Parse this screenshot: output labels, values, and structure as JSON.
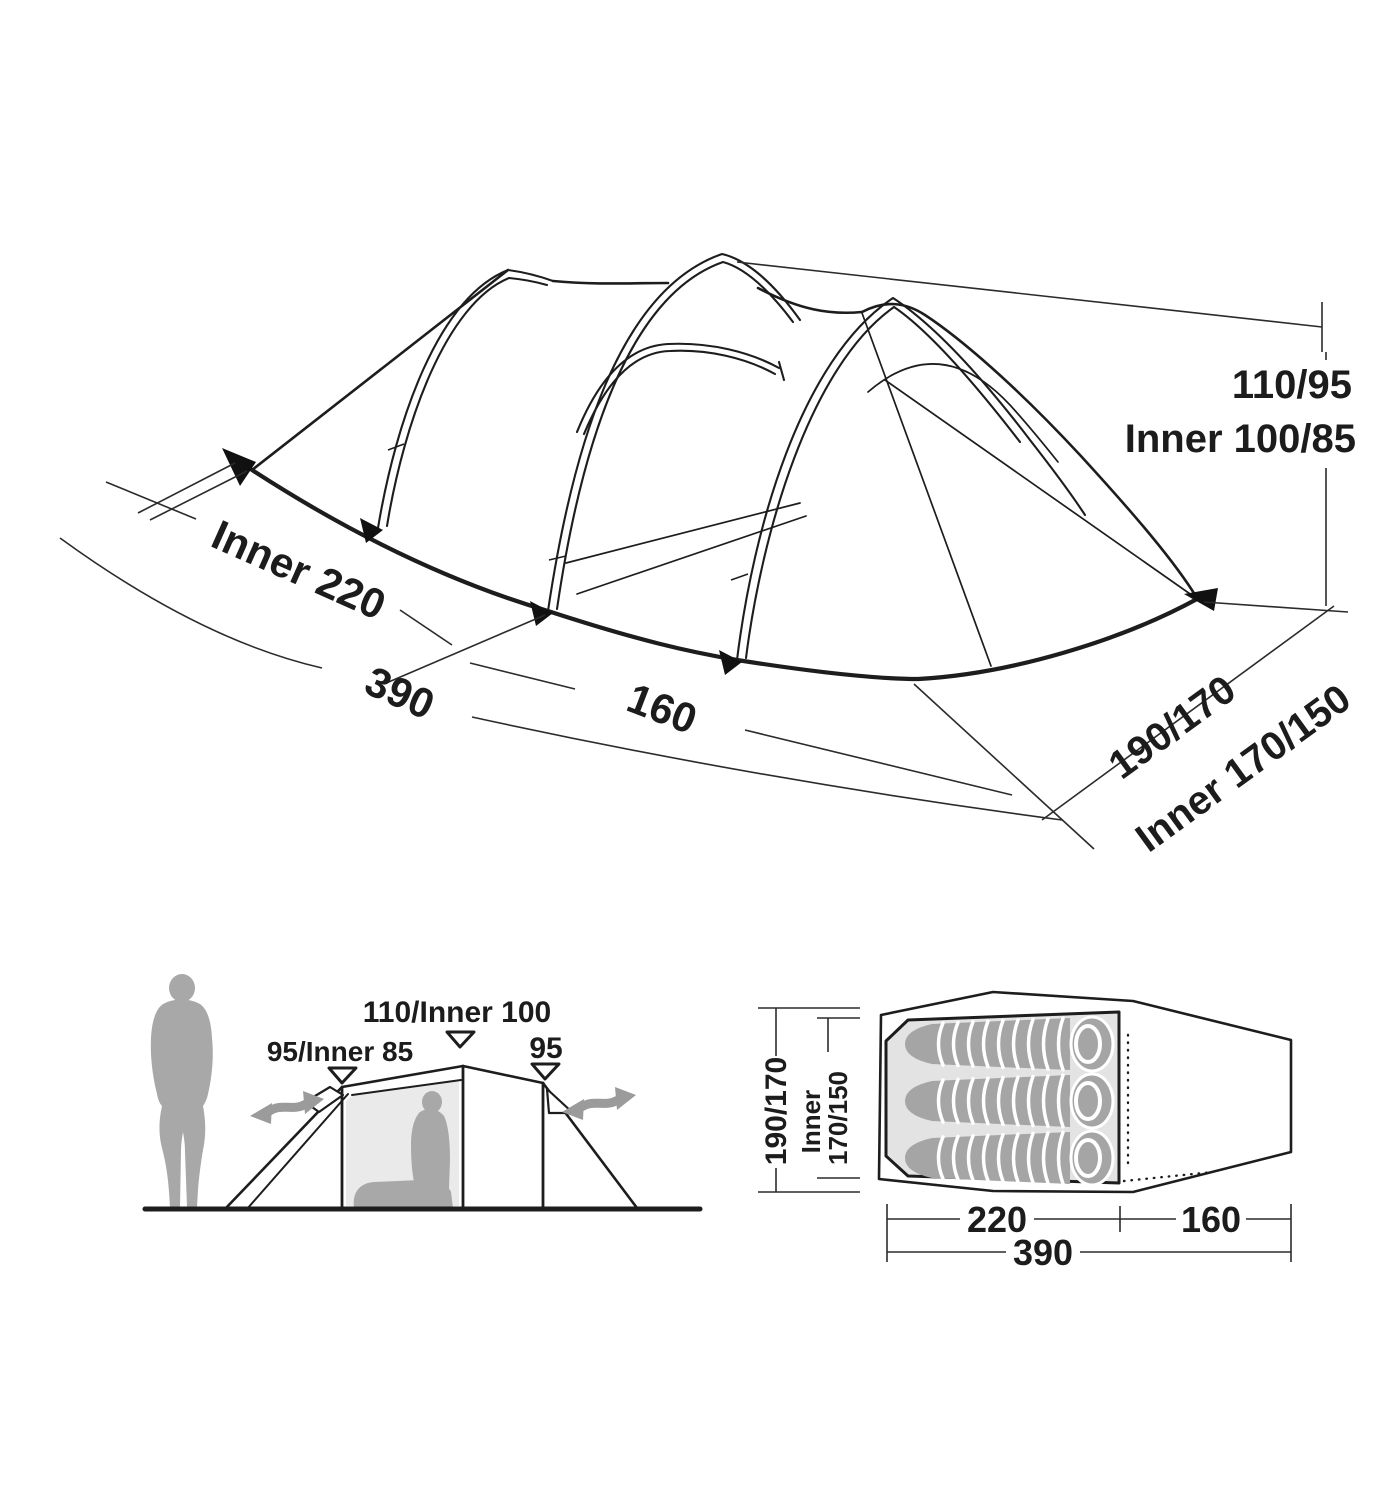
{
  "figure": {
    "description": "Tent dimension diagram: perspective view, side elevation with person, and floor plan",
    "colors": {
      "line": "#1d1d1d",
      "dimension_line": "#2b2b2b",
      "inner_tent_fill": "#e3e3e3",
      "silhouette_gray": "#a8a8a8",
      "sleeping_bag_gray": "#a5a5a5",
      "arrow_gray": "#9b9b9b",
      "background": "#ffffff"
    }
  },
  "perspective_view": {
    "peak_height": "110/95",
    "peak_height_inner": "Inner 100/85",
    "inner_length": "Inner 220",
    "total_length": "390",
    "porch_length": "160",
    "width": "190/170",
    "width_inner": "Inner 170/150"
  },
  "side_view": {
    "rear_peak": "95/Inner 85",
    "main_peak": "110/Inner 100",
    "front_peak": "95"
  },
  "plan_view": {
    "width": "190/170",
    "width_inner_line1": "Inner",
    "width_inner_line2": "170/150",
    "inner_length": "220",
    "porch_length": "160",
    "total_length": "390",
    "sleeping_bag_count": 3
  }
}
